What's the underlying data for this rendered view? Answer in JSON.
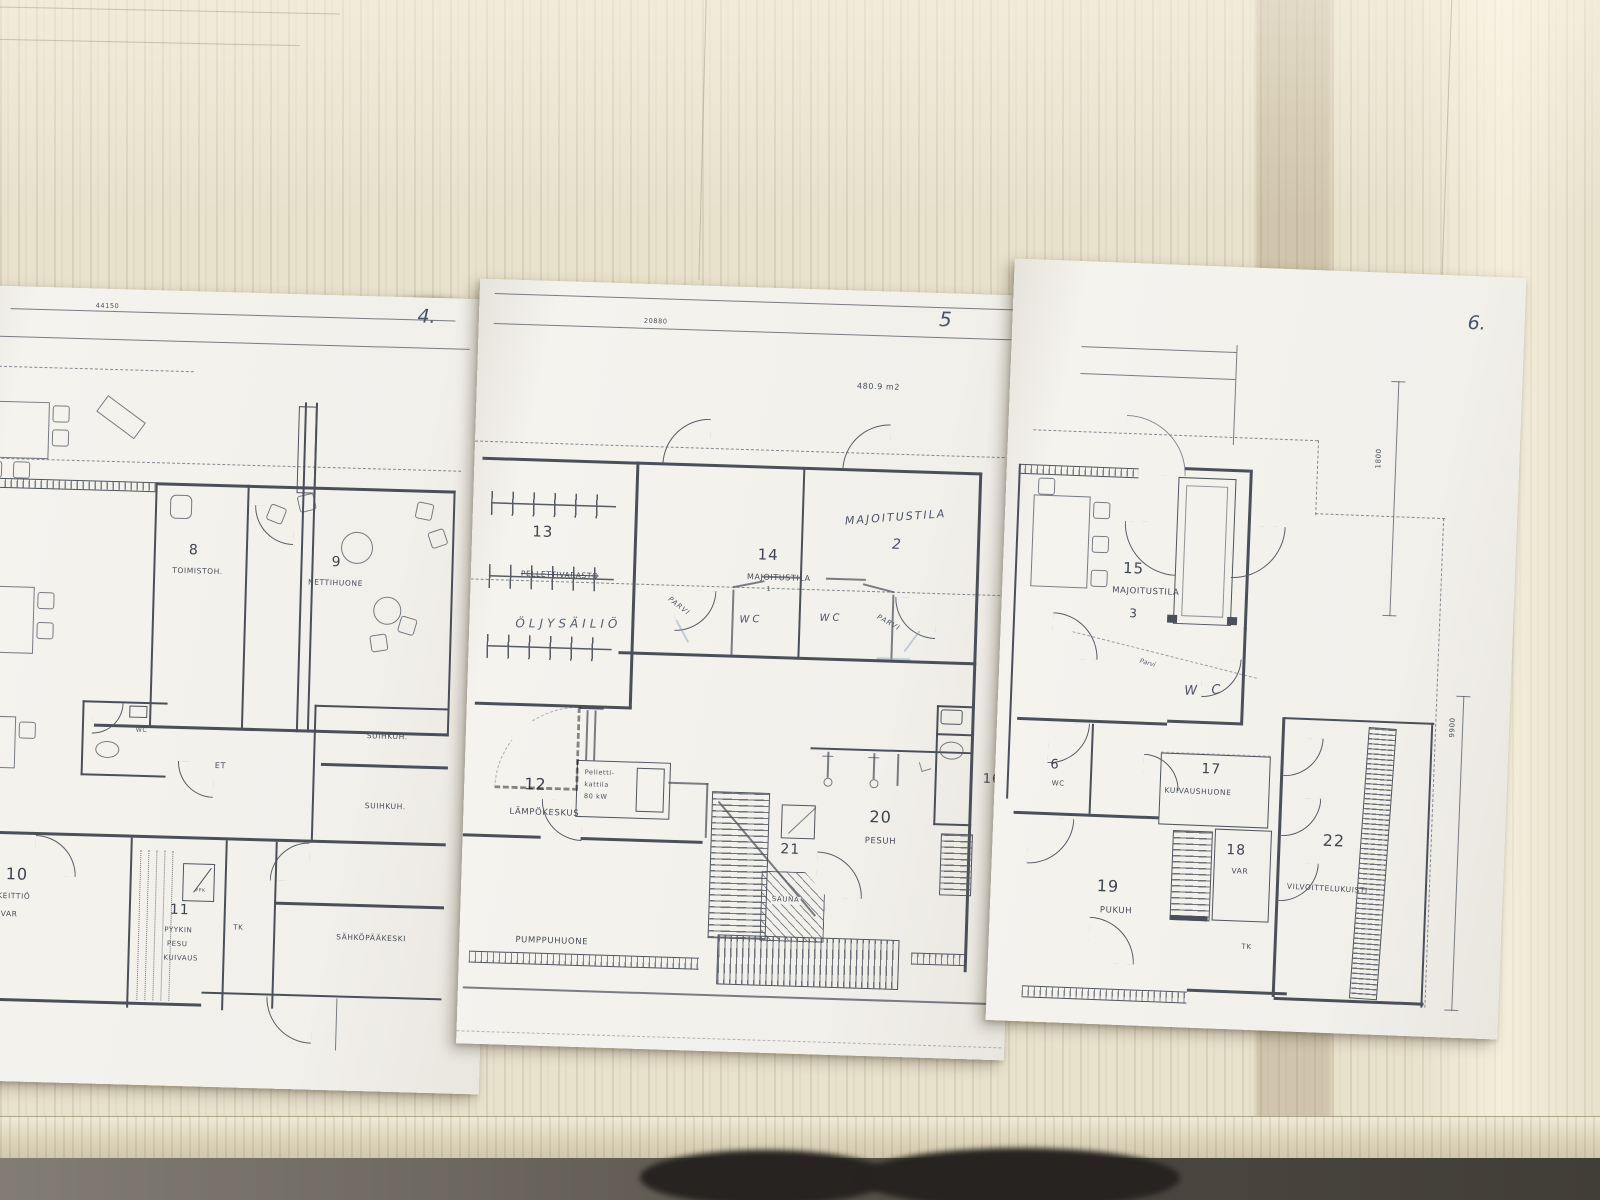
{
  "page4": {
    "page_number": "4.",
    "dim_top": "44150",
    "r8_number": "8",
    "r8_name": "TOIMISTOH.",
    "r9_number": "9",
    "r9_name": "NETTIHUONE",
    "r10_number": "10",
    "r10_name1": "KEITTIÖ",
    "r10_name2": "VAR",
    "r11_number": "11",
    "r11_name1": "PYYKIN",
    "r11_name2": "PESU",
    "r11_name3": "KUIVAUS",
    "ppk": "PPK",
    "wc": "WC",
    "et": "ET",
    "suihku1": "SUIHKUH.",
    "suihku2": "SUIHKUH.",
    "tk": "TK",
    "sahkopaakeskus": "SÄHKÖPÄÄKESKI"
  },
  "page5": {
    "page_number": "5",
    "dim_top": "20880",
    "area": "480.9 m2",
    "r13_number": "13",
    "r13_name": "PELLETTIVARASTO",
    "r13_handwritten": "ÖLJYSÄILIÖ",
    "r14_number": "14",
    "r14_name": "MAJOITUSTILA",
    "r14_sub": "1",
    "hw_majoitustila": "MAJOITUSTILA",
    "hw_majoitustila_sub": "2",
    "hw_wc_left": "WC",
    "hw_wc_right": "WC",
    "hw_parvi_left": "PARVI",
    "hw_parvi_right": "PARVI",
    "r12_number": "12",
    "r12_name": "LÄMPÖKESKUS",
    "boiler1": "Pelletti-",
    "boiler2": "kattila",
    "boiler3": "80 kW",
    "r20_number": "20",
    "r20_name": "PESUH",
    "r21_number": "21",
    "r21_name": "SAUNA",
    "r16_number": "16",
    "pumppuhuone": "PUMPPUHUONE"
  },
  "page6": {
    "page_number": "6.",
    "dim_1800": "1800",
    "dim_9900": "9900",
    "r15_number": "15",
    "r15_name": "MAJOITUSTILA",
    "r15_sub": "3",
    "hw_parvi": "Parvi",
    "hw_wc": "W C",
    "r6_number": "6",
    "r6_name": "WC",
    "r17_number": "17",
    "r17_name": "KUIVAUSHUONE",
    "r18_number": "18",
    "r18_name": "VAR",
    "r19_number": "19",
    "r19_name": "PUKUH",
    "r22_number": "22",
    "r22_name": "VILVOITTELUKUISTI",
    "tk": "TK"
  }
}
